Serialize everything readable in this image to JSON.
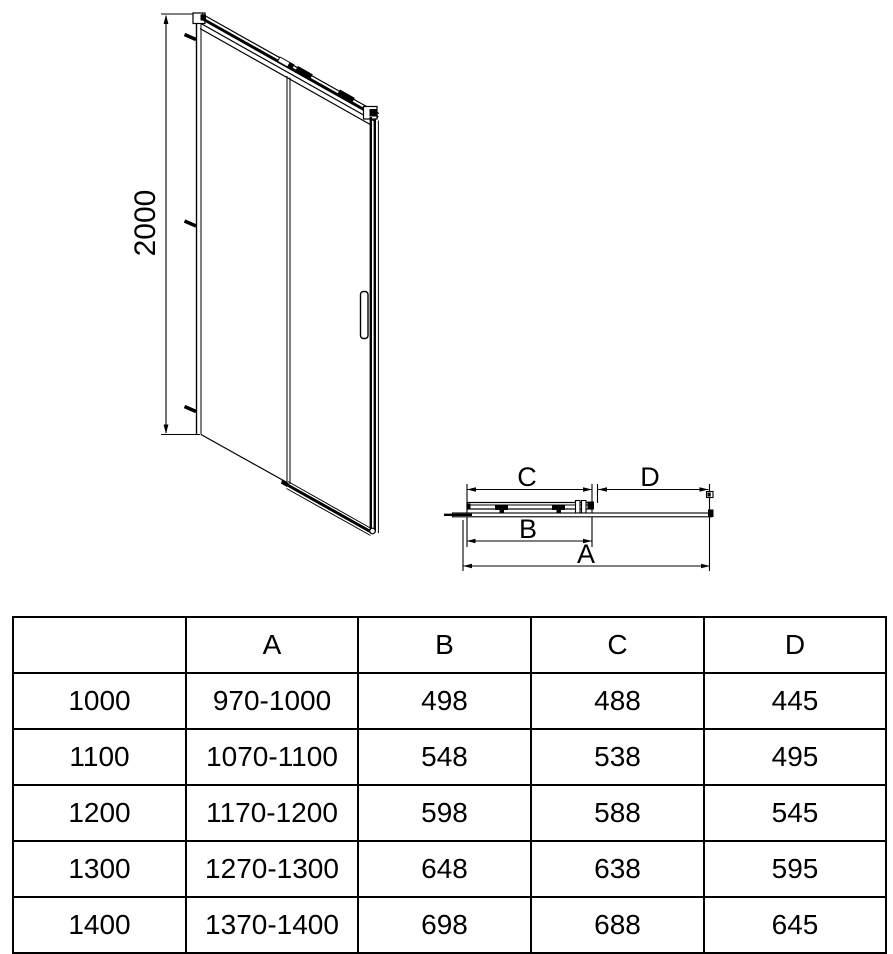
{
  "diagram": {
    "front_view": {
      "height_dim_label": "2000"
    },
    "top_view": {
      "dim_a_label": "A",
      "dim_b_label": "B",
      "dim_c_label": "C",
      "dim_d_label": "D"
    },
    "colors": {
      "line": "#000000",
      "background": "#ffffff"
    }
  },
  "table": {
    "headers": {
      "size": "",
      "a": "A",
      "b": "B",
      "c": "C",
      "d": "D"
    },
    "rows": [
      {
        "size": "1000",
        "a": "970-1000",
        "b": "498",
        "c": "488",
        "d": "445"
      },
      {
        "size": "1100",
        "a": "1070-1100",
        "b": "548",
        "c": "538",
        "d": "495"
      },
      {
        "size": "1200",
        "a": "1170-1200",
        "b": "598",
        "c": "588",
        "d": "545"
      },
      {
        "size": "1300",
        "a": "1270-1300",
        "b": "648",
        "c": "638",
        "d": "595"
      },
      {
        "size": "1400",
        "a": "1370-1400",
        "b": "698",
        "c": "688",
        "d": "645"
      }
    ]
  }
}
